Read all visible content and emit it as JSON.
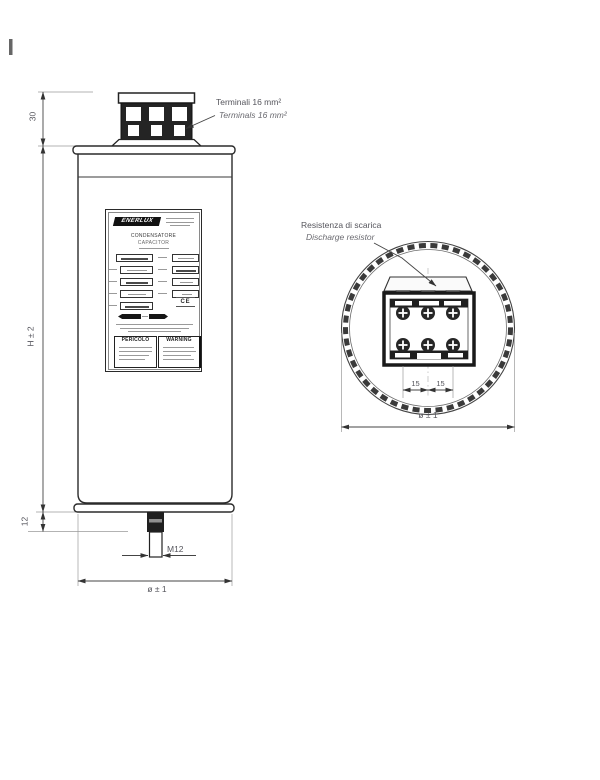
{
  "drawing": {
    "frame": {
      "present": true
    },
    "side_view": {
      "dims": {
        "terminal_height": "30",
        "body_height": "H ± 2",
        "stud_section": "12",
        "stud_thread": "M12",
        "diameter": "ø ± 1"
      },
      "terminal_note": {
        "line1": "Terminali 16 mm²",
        "line2": "Terminals 16 mm²"
      }
    },
    "top_view": {
      "discharge_note": {
        "line1": "Resistenza di scarica",
        "line2": "Discharge resistor"
      },
      "dims": {
        "pitch_left": "15",
        "pitch_right": "15",
        "diameter": "ø ± 1"
      },
      "terminal_screws": 6
    },
    "nameplate": {
      "brand": "ENERLUX",
      "title_line1": "CONDENSATORE",
      "title_line2": "CAPACITOR",
      "danger_it": "PERICOLO",
      "danger_en": "WARNING",
      "ce_mark": "CE"
    },
    "colors": {
      "line": "#2b2b2b",
      "dim_line": "#444444",
      "witness": "#999999",
      "text": "#55555c",
      "fill_dark": "#1f1f1f",
      "background": "#ffffff"
    }
  }
}
